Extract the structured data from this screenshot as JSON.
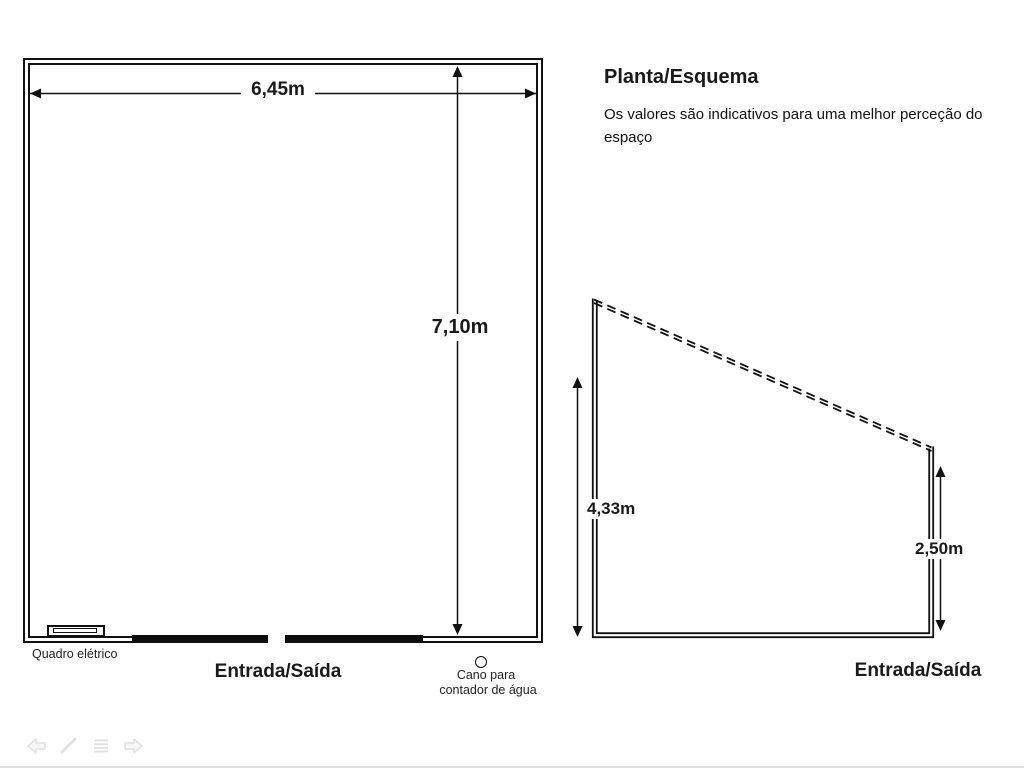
{
  "slide": {
    "title": "Planta/Esquema",
    "subtitle": "Os valores são indicativos para uma melhor perceção do espaço"
  },
  "floor_plan": {
    "width_dimension": "6,45m",
    "height_dimension": "7,10m",
    "electrical_panel_label": "Quadro elétrico",
    "entrance_label": "Entrada/Saída",
    "water_pipe_label_line1": "Cano para",
    "water_pipe_label_line2": "contador de água"
  },
  "section_view": {
    "left_height_dimension": "4,33m",
    "right_height_dimension": "2,50m",
    "entrance_label": "Entrada/Saída"
  },
  "presentation_toolbar": {
    "buttons": [
      "previous-slide",
      "pen",
      "menu",
      "next-slide"
    ]
  },
  "colors": {
    "line": "#111111",
    "background": "#ffffff",
    "toolbar_icon": "#e3e3e3"
  }
}
